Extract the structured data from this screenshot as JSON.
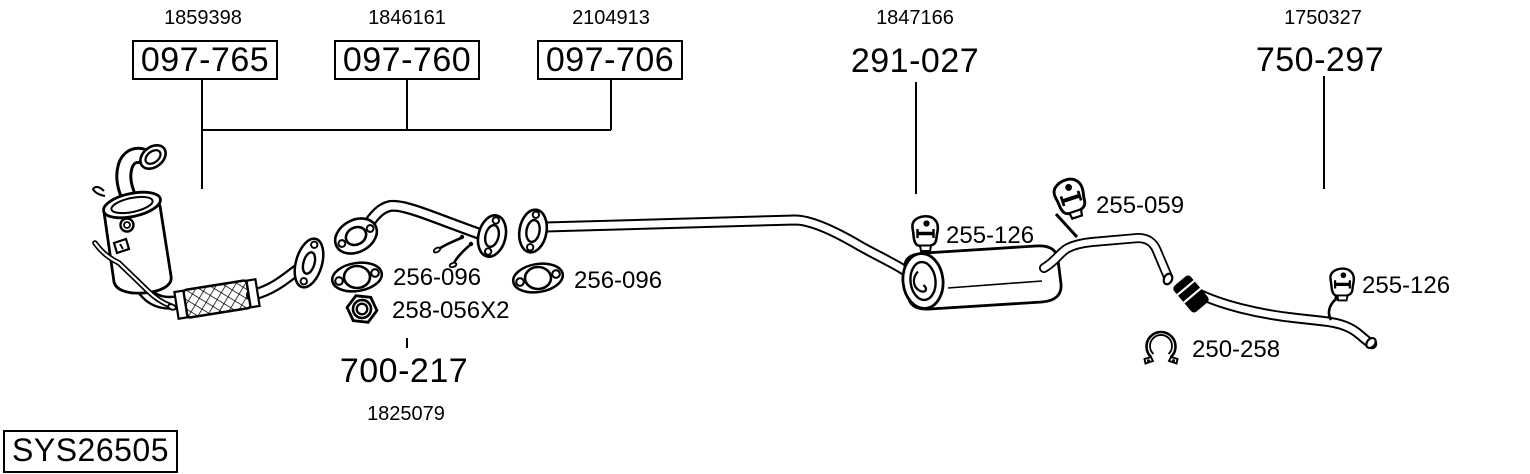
{
  "page": {
    "background": "#ffffff",
    "ink": "#000000"
  },
  "system": {
    "code": "SYS26505"
  },
  "assemblies": [
    {
      "oe_ref": "1859398",
      "part_number": "097-765",
      "boxed": true,
      "component": "catalytic-converter"
    },
    {
      "oe_ref": "1846161",
      "part_number": "097-760",
      "boxed": true,
      "component": "front-pipe"
    },
    {
      "oe_ref": "2104913",
      "part_number": "097-706",
      "boxed": true,
      "component": "centre-pipe"
    },
    {
      "oe_ref": "1847166",
      "part_number": "291-027",
      "boxed": false,
      "component": "centre-silencer"
    },
    {
      "oe_ref": "1750327",
      "part_number": "750-297",
      "boxed": false,
      "component": "tail-pipe"
    },
    {
      "oe_ref": "1825079",
      "part_number": "700-217",
      "boxed": false,
      "component": "mounting-kit"
    }
  ],
  "hardware": [
    {
      "part_number": "256-096",
      "component": "gasket"
    },
    {
      "part_number": "256-096",
      "component": "gasket"
    },
    {
      "part_number": "258-056X2",
      "component": "hex-nut"
    },
    {
      "part_number": "255-126",
      "component": "rubber-mounting"
    },
    {
      "part_number": "255-059",
      "component": "rubber-mounting"
    },
    {
      "part_number": "255-126",
      "component": "rubber-mounting"
    },
    {
      "part_number": "250-258",
      "component": "pipe-clamp"
    }
  ]
}
